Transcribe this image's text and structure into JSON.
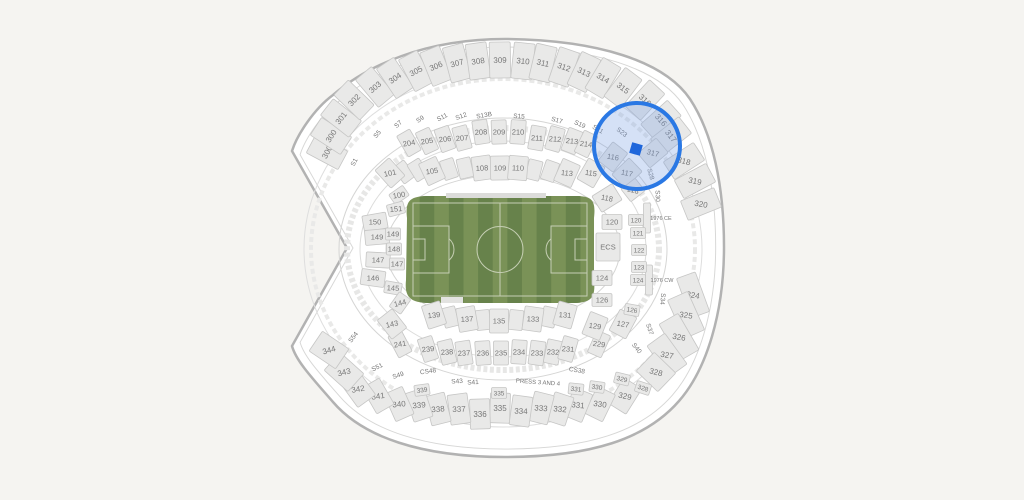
{
  "canvas": {
    "width": 1024,
    "height": 500,
    "background": "#f5f4f1"
  },
  "map": {
    "stadium_fill": "#ffffff",
    "stadium_stroke": "#b2b2b2",
    "inner_ring_stroke": "#d7d7d6",
    "section_fill": "#e9e9e8",
    "section_stroke": "#c6c6c5",
    "label_color": "#747474",
    "suite_label_color": "#8c8c8c",
    "field": {
      "grass_light": "#7a9257",
      "grass_dark": "#67824b",
      "line_color": "#c6cfb4",
      "tunnel_color": "#dcdcda"
    },
    "highlight": {
      "cx": 637,
      "cy": 146,
      "r": 43,
      "ring_color": "#2a78e4",
      "fill_color": "rgba(125,162,228,0.32)",
      "marker": {
        "x": 636,
        "y": 149,
        "size": 11,
        "rot": 16,
        "color": "#1e66db"
      }
    },
    "tiers": {
      "u": {
        "w": 21,
        "h": 36,
        "fs": 8
      },
      "m": {
        "w": 15,
        "h": 24,
        "fs": 7.5
      },
      "l": {
        "w": 19,
        "h": 24,
        "fs": 7.5
      },
      "c": {
        "w": 20,
        "h": 15,
        "fs": 7.5
      },
      "s": {
        "w": 15,
        "h": 11,
        "fs": 6.5
      },
      "x": {
        "box": false,
        "fs": 6.5
      },
      "n": {
        "box": false,
        "fs": 5.5
      },
      "p": {
        "box": false,
        "fs": 6
      }
    },
    "section_fields": [
      "label",
      "x",
      "y",
      "rot",
      "tier",
      "text_rot",
      "w",
      "h"
    ],
    "sections": [
      [
        "300",
        327,
        152,
        -62,
        "u"
      ],
      [
        "300",
        331,
        136,
        -57,
        "u"
      ],
      [
        "301",
        341,
        118,
        -52,
        "u"
      ],
      [
        "302",
        354,
        100,
        -46,
        "u"
      ],
      [
        "303",
        375,
        87,
        -40,
        "u"
      ],
      [
        "304",
        395,
        78,
        -34,
        "u"
      ],
      [
        "305",
        416,
        71,
        -28,
        "u"
      ],
      [
        "306",
        436,
        66,
        -22,
        "u"
      ],
      [
        "307",
        457,
        63,
        -15,
        "u"
      ],
      [
        "308",
        478,
        61,
        -8,
        "u"
      ],
      [
        "309",
        500,
        60,
        -1,
        "u"
      ],
      [
        "310",
        523,
        61,
        6,
        "u"
      ],
      [
        "311",
        543,
        63,
        13,
        "u"
      ],
      [
        "312",
        564,
        67,
        19,
        "u"
      ],
      [
        "313",
        584,
        72,
        25,
        "u"
      ],
      [
        "314",
        603,
        78,
        31,
        "u"
      ],
      [
        "315",
        623,
        88,
        37,
        "u"
      ],
      [
        "316",
        645,
        100,
        43,
        "u"
      ],
      [
        "316",
        661,
        120,
        48,
        "u"
      ],
      [
        "317",
        671,
        136,
        52,
        "u"
      ],
      [
        "318",
        684,
        161,
        57,
        "u",
        15
      ],
      [
        "319",
        695,
        181,
        62,
        "u",
        12
      ],
      [
        "320",
        701,
        204,
        68,
        "u",
        10
      ],
      [
        "324",
        693,
        295,
        70,
        "u",
        10,
        42,
        20
      ],
      [
        "325",
        686,
        315,
        66,
        "u",
        8,
        42,
        22
      ],
      [
        "326",
        679,
        337,
        60,
        "u",
        10,
        42,
        22
      ],
      [
        "327",
        667,
        355,
        54,
        "u",
        10,
        38,
        22
      ],
      [
        "328",
        656,
        372,
        44,
        "u",
        14,
        30,
        26
      ],
      [
        "329",
        625,
        396,
        32,
        "u",
        12,
        21,
        30
      ],
      [
        "330",
        600,
        404,
        26,
        "u",
        8,
        20,
        30
      ],
      [
        "331",
        578,
        405,
        22,
        "u",
        6,
        20,
        30
      ],
      [
        "332",
        560,
        409,
        18,
        "u",
        5,
        20,
        30
      ],
      [
        "333",
        541,
        408,
        14,
        "u",
        4,
        20,
        30
      ],
      [
        "334",
        521,
        411,
        8,
        "u",
        2,
        20,
        30
      ],
      [
        "335",
        500,
        408,
        2,
        "u",
        0,
        20,
        30
      ],
      [
        "336",
        480,
        414,
        -2,
        "u",
        0,
        20,
        30
      ],
      [
        "337",
        459,
        409,
        -8,
        "u",
        -2,
        20,
        30
      ],
      [
        "338",
        438,
        409,
        -14,
        "u",
        -4,
        20,
        30
      ],
      [
        "339",
        419,
        405,
        -18,
        "u",
        -5,
        20,
        30
      ],
      [
        "340",
        399,
        404,
        -24,
        "u",
        -6,
        20,
        30
      ],
      [
        "341",
        378,
        396,
        -30,
        "u",
        -8,
        20,
        30
      ],
      [
        "342",
        358,
        389,
        -36,
        "u",
        -10,
        22,
        30
      ],
      [
        "343",
        344,
        372,
        -48,
        "u",
        -14,
        24,
        32
      ],
      [
        "344",
        329,
        350,
        -56,
        "u",
        -16,
        24,
        32
      ],
      [
        "204",
        409,
        143,
        -30,
        "m",
        -10
      ],
      [
        "205",
        427,
        141,
        -25,
        "m",
        -8
      ],
      [
        "206",
        445,
        139,
        -20,
        "m",
        -6
      ],
      [
        "207",
        462,
        138,
        -15,
        "m",
        -5
      ],
      [
        "208",
        481,
        132,
        -9,
        "m",
        -3
      ],
      [
        "209",
        499,
        132,
        -2,
        "m",
        0
      ],
      [
        "210",
        518,
        132,
        4,
        "m",
        1
      ],
      [
        "211",
        537,
        138,
        10,
        "m",
        3
      ],
      [
        "212",
        555,
        139,
        16,
        "m",
        5
      ],
      [
        "213",
        572,
        141,
        21,
        "m",
        6
      ],
      [
        "214",
        586,
        144,
        26,
        "m",
        8
      ],
      [
        "241",
        400,
        344,
        -28,
        "m",
        -9
      ],
      [
        "239",
        428,
        349,
        -18,
        "m",
        -6
      ],
      [
        "238",
        447,
        352,
        -14,
        "m",
        -4
      ],
      [
        "237",
        464,
        353,
        -9,
        "m",
        -3
      ],
      [
        "236",
        483,
        353,
        -4,
        "m",
        -1
      ],
      [
        "235",
        501,
        353,
        0,
        "m",
        0
      ],
      [
        "234",
        519,
        352,
        4,
        "m",
        1
      ],
      [
        "233",
        537,
        353,
        8,
        "m",
        2
      ],
      [
        "232",
        553,
        352,
        12,
        "m",
        3
      ],
      [
        "231",
        568,
        349,
        16,
        "m",
        5
      ],
      [
        "229",
        599,
        344,
        24,
        "m",
        8
      ],
      [
        "101",
        390,
        173,
        -42,
        "l",
        -12
      ],
      [
        "105",
        432,
        171,
        -25,
        "l",
        -8
      ],
      [
        "108",
        482,
        168,
        -8,
        "l",
        -3
      ],
      [
        "109",
        500,
        168,
        -1,
        "l",
        0
      ],
      [
        "110",
        518,
        168,
        5,
        "l",
        2
      ],
      [
        "113",
        567,
        173,
        24,
        "l",
        6
      ],
      [
        "115",
        591,
        173,
        30,
        "l",
        8
      ],
      [
        "116",
        613,
        157,
        38,
        "l",
        10
      ],
      [
        "117",
        627,
        173,
        46,
        "l",
        12
      ],
      [
        "118",
        633,
        190,
        52,
        "l",
        14,
        16,
        18
      ],
      [
        "118",
        607,
        198,
        58,
        "l",
        12
      ],
      [
        "317",
        653,
        153,
        50,
        "l",
        14
      ],
      [
        "139",
        434,
        315,
        -18,
        "l",
        -6
      ],
      [
        "137",
        467,
        319,
        -10,
        "l",
        -3
      ],
      [
        "135",
        499,
        321,
        0,
        "l",
        0
      ],
      [
        "133",
        533,
        319,
        8,
        "l",
        3
      ],
      [
        "131",
        565,
        315,
        16,
        "l",
        5
      ],
      [
        "129",
        595,
        326,
        22,
        "l",
        8
      ],
      [
        "127",
        623,
        324,
        28,
        "l",
        10
      ],
      [
        "143",
        392,
        324,
        -38,
        "l",
        -12
      ],
      [
        "150",
        375,
        222,
        -10,
        "c",
        0,
        24,
        16
      ],
      [
        "149",
        377,
        237,
        -5,
        "c",
        0,
        24,
        15
      ],
      [
        "147",
        378,
        260,
        3,
        "c",
        0,
        24,
        15
      ],
      [
        "146",
        373,
        278,
        8,
        "c",
        0,
        24,
        16
      ],
      [
        "100",
        399,
        195,
        -35,
        "c",
        -10,
        17,
        12
      ],
      [
        "151",
        396,
        209,
        -15,
        "c",
        -5,
        17,
        12
      ],
      [
        "149",
        393,
        234,
        0,
        "c",
        0,
        15,
        12
      ],
      [
        "148",
        394,
        249,
        0,
        "c",
        0,
        15,
        12
      ],
      [
        "147",
        397,
        264,
        0,
        "c",
        0,
        15,
        12
      ],
      [
        "145",
        393,
        288,
        10,
        "c",
        3,
        17,
        12
      ],
      [
        "144",
        400,
        303,
        -55,
        "c",
        -14,
        18,
        14
      ],
      [
        "120",
        612,
        222,
        0,
        "c"
      ],
      [
        "ECS",
        608,
        247,
        0,
        "c",
        0,
        24,
        28
      ],
      [
        "124",
        602,
        278,
        0,
        "c"
      ],
      [
        "126",
        602,
        300,
        0,
        "c",
        0,
        20,
        13
      ],
      [
        "120",
        636,
        220,
        0,
        "s"
      ],
      [
        "121",
        638,
        233,
        0,
        "s"
      ],
      [
        "122",
        639,
        250,
        0,
        "s"
      ],
      [
        "123",
        639,
        267,
        0,
        "s"
      ],
      [
        "124",
        638,
        280,
        0,
        "s"
      ],
      [
        "126",
        632,
        310,
        10,
        "s"
      ],
      [
        "339",
        422,
        390,
        -8,
        "s"
      ],
      [
        "335",
        499,
        393,
        0,
        "s"
      ],
      [
        "331",
        576,
        389,
        6,
        "s"
      ],
      [
        "330",
        597,
        387,
        8,
        "s"
      ],
      [
        "329",
        622,
        379,
        14,
        "s"
      ],
      [
        "328",
        643,
        388,
        18,
        "s"
      ],
      [
        "S1",
        354,
        162,
        -62,
        "x"
      ],
      [
        "S5",
        377,
        134,
        -50,
        "x"
      ],
      [
        "S7",
        398,
        124,
        -43,
        "x"
      ],
      [
        "S9",
        420,
        119,
        -35,
        "x"
      ],
      [
        "S11",
        442,
        117,
        -27,
        "x"
      ],
      [
        "S12",
        461,
        116,
        -20,
        "x"
      ],
      [
        "S13B",
        484,
        115,
        -10,
        "x"
      ],
      [
        "S15",
        519,
        116,
        4,
        "x"
      ],
      [
        "S17",
        557,
        120,
        16,
        "x"
      ],
      [
        "S19",
        580,
        124,
        24,
        "x"
      ],
      [
        "S21",
        598,
        129,
        30,
        "x"
      ],
      [
        "S23",
        622,
        132,
        38,
        "x"
      ],
      [
        "S28",
        651,
        174,
        75,
        "x"
      ],
      [
        "S30",
        658,
        196,
        88,
        "x"
      ],
      [
        "S34",
        663,
        299,
        95,
        "x"
      ],
      [
        "S37",
        650,
        329,
        72,
        "x"
      ],
      [
        "S40",
        637,
        348,
        52,
        "x"
      ],
      [
        "CS38",
        577,
        370,
        10,
        "x"
      ],
      [
        "S41",
        473,
        382,
        -3,
        "x"
      ],
      [
        "S43",
        457,
        381,
        -4,
        "x"
      ],
      [
        "CS48",
        428,
        371,
        -8,
        "x"
      ],
      [
        "S49",
        398,
        375,
        -18,
        "x"
      ],
      [
        "S51",
        377,
        367,
        -26,
        "x"
      ],
      [
        "S54",
        353,
        337,
        -52,
        "x"
      ],
      [
        "1976 CE",
        661,
        218,
        0,
        "n"
      ],
      [
        "1976 CW",
        662,
        280,
        0,
        "n"
      ],
      [
        "PRESS 3 AND 4",
        538,
        382,
        4,
        "p"
      ]
    ],
    "filler_fields": [
      "x",
      "y",
      "rot",
      "w",
      "h"
    ],
    "fillers": [
      [
        404,
        172,
        -37
      ],
      [
        418,
        170,
        -32
      ],
      [
        449,
        169,
        -18
      ],
      [
        465,
        168,
        -13
      ],
      [
        534,
        170,
        14
      ],
      [
        550,
        171,
        19
      ],
      [
        450,
        317,
        -14
      ],
      [
        483,
        320,
        -6
      ],
      [
        516,
        320,
        6
      ],
      [
        549,
        317,
        12
      ],
      [
        647,
        218,
        0,
        7,
        30
      ],
      [
        649,
        280,
        0,
        7,
        30
      ]
    ]
  }
}
